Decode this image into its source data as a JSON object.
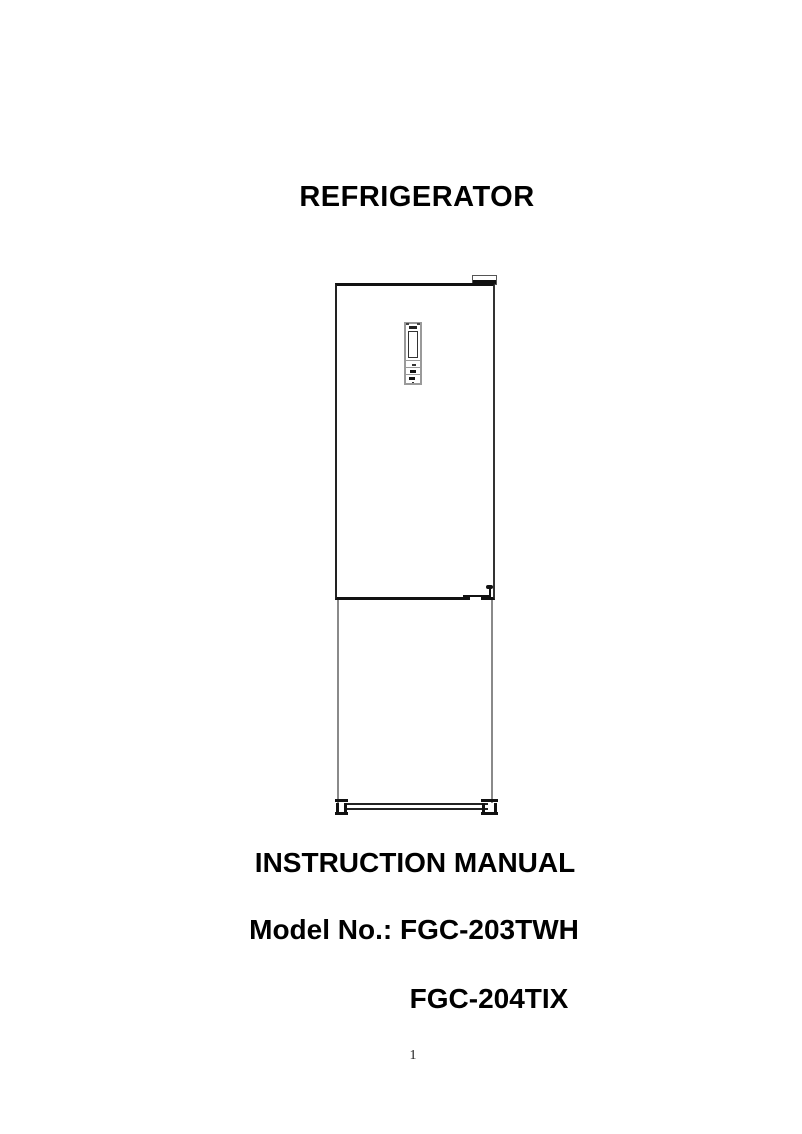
{
  "document": {
    "title": "REFRIGERATOR",
    "manual_heading": "INSTRUCTION MANUAL",
    "model_primary": "Model No.: FGC-203TWH",
    "model_secondary": "FGC-204TIX",
    "page_number": "1"
  },
  "figure": {
    "name": "refrigerator-front-line-drawing",
    "parts": [
      "top-hinge-cover",
      "upper-door",
      "electronic-control-panel",
      "middle-hinge",
      "lower-freezer-door",
      "kick-plate",
      "leveling-feet"
    ]
  },
  "colors": {
    "background": "#ffffff",
    "text": "#000000",
    "outline_dark": "#111111",
    "outline_gray": "#8a8a8a"
  }
}
